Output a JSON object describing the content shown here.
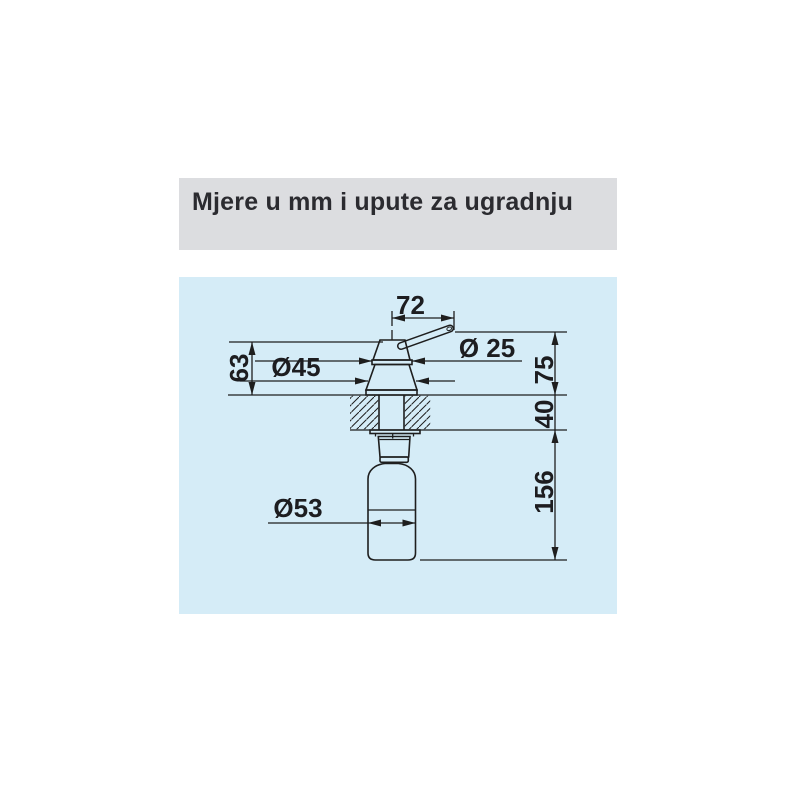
{
  "header": {
    "title": "Mjere u mm i upute za ugradnju"
  },
  "drawing": {
    "dimensions": {
      "spout_reach": "72",
      "spout_diameter": "Ø 25",
      "head_diameter": "Ø45",
      "head_height": "63",
      "height_above_counter": "75",
      "counter_thickness": "40",
      "depth_below_counter": "156",
      "bottle_diameter": "Ø53"
    },
    "colors": {
      "header_bg": "#dcdde0",
      "panel_bg": "#d5ecf7",
      "line": "#1e1e1e",
      "text": "#1d1d20"
    }
  }
}
